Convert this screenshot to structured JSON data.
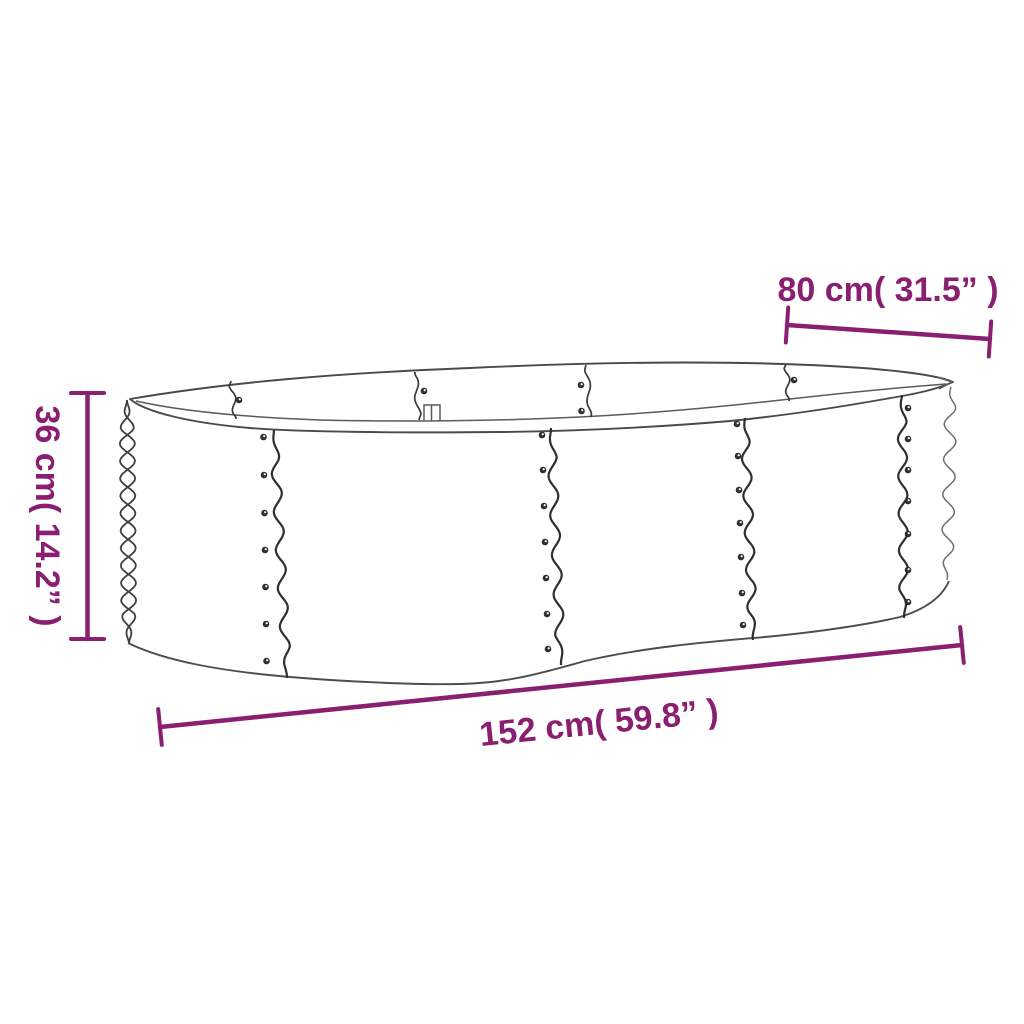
{
  "title": "Raised garden bed dimension diagram",
  "product": "oval corrugated metal raised garden bed line drawing",
  "colors": {
    "accent": "#8A1E70",
    "line": "#4a4a4a",
    "background": "#ffffff"
  },
  "annotations": {
    "width": {
      "label": "80 cm( 31.5” )"
    },
    "height": {
      "label": "36 cm( 14.2” )"
    },
    "length": {
      "label": "152 cm( 59.8” )"
    }
  }
}
